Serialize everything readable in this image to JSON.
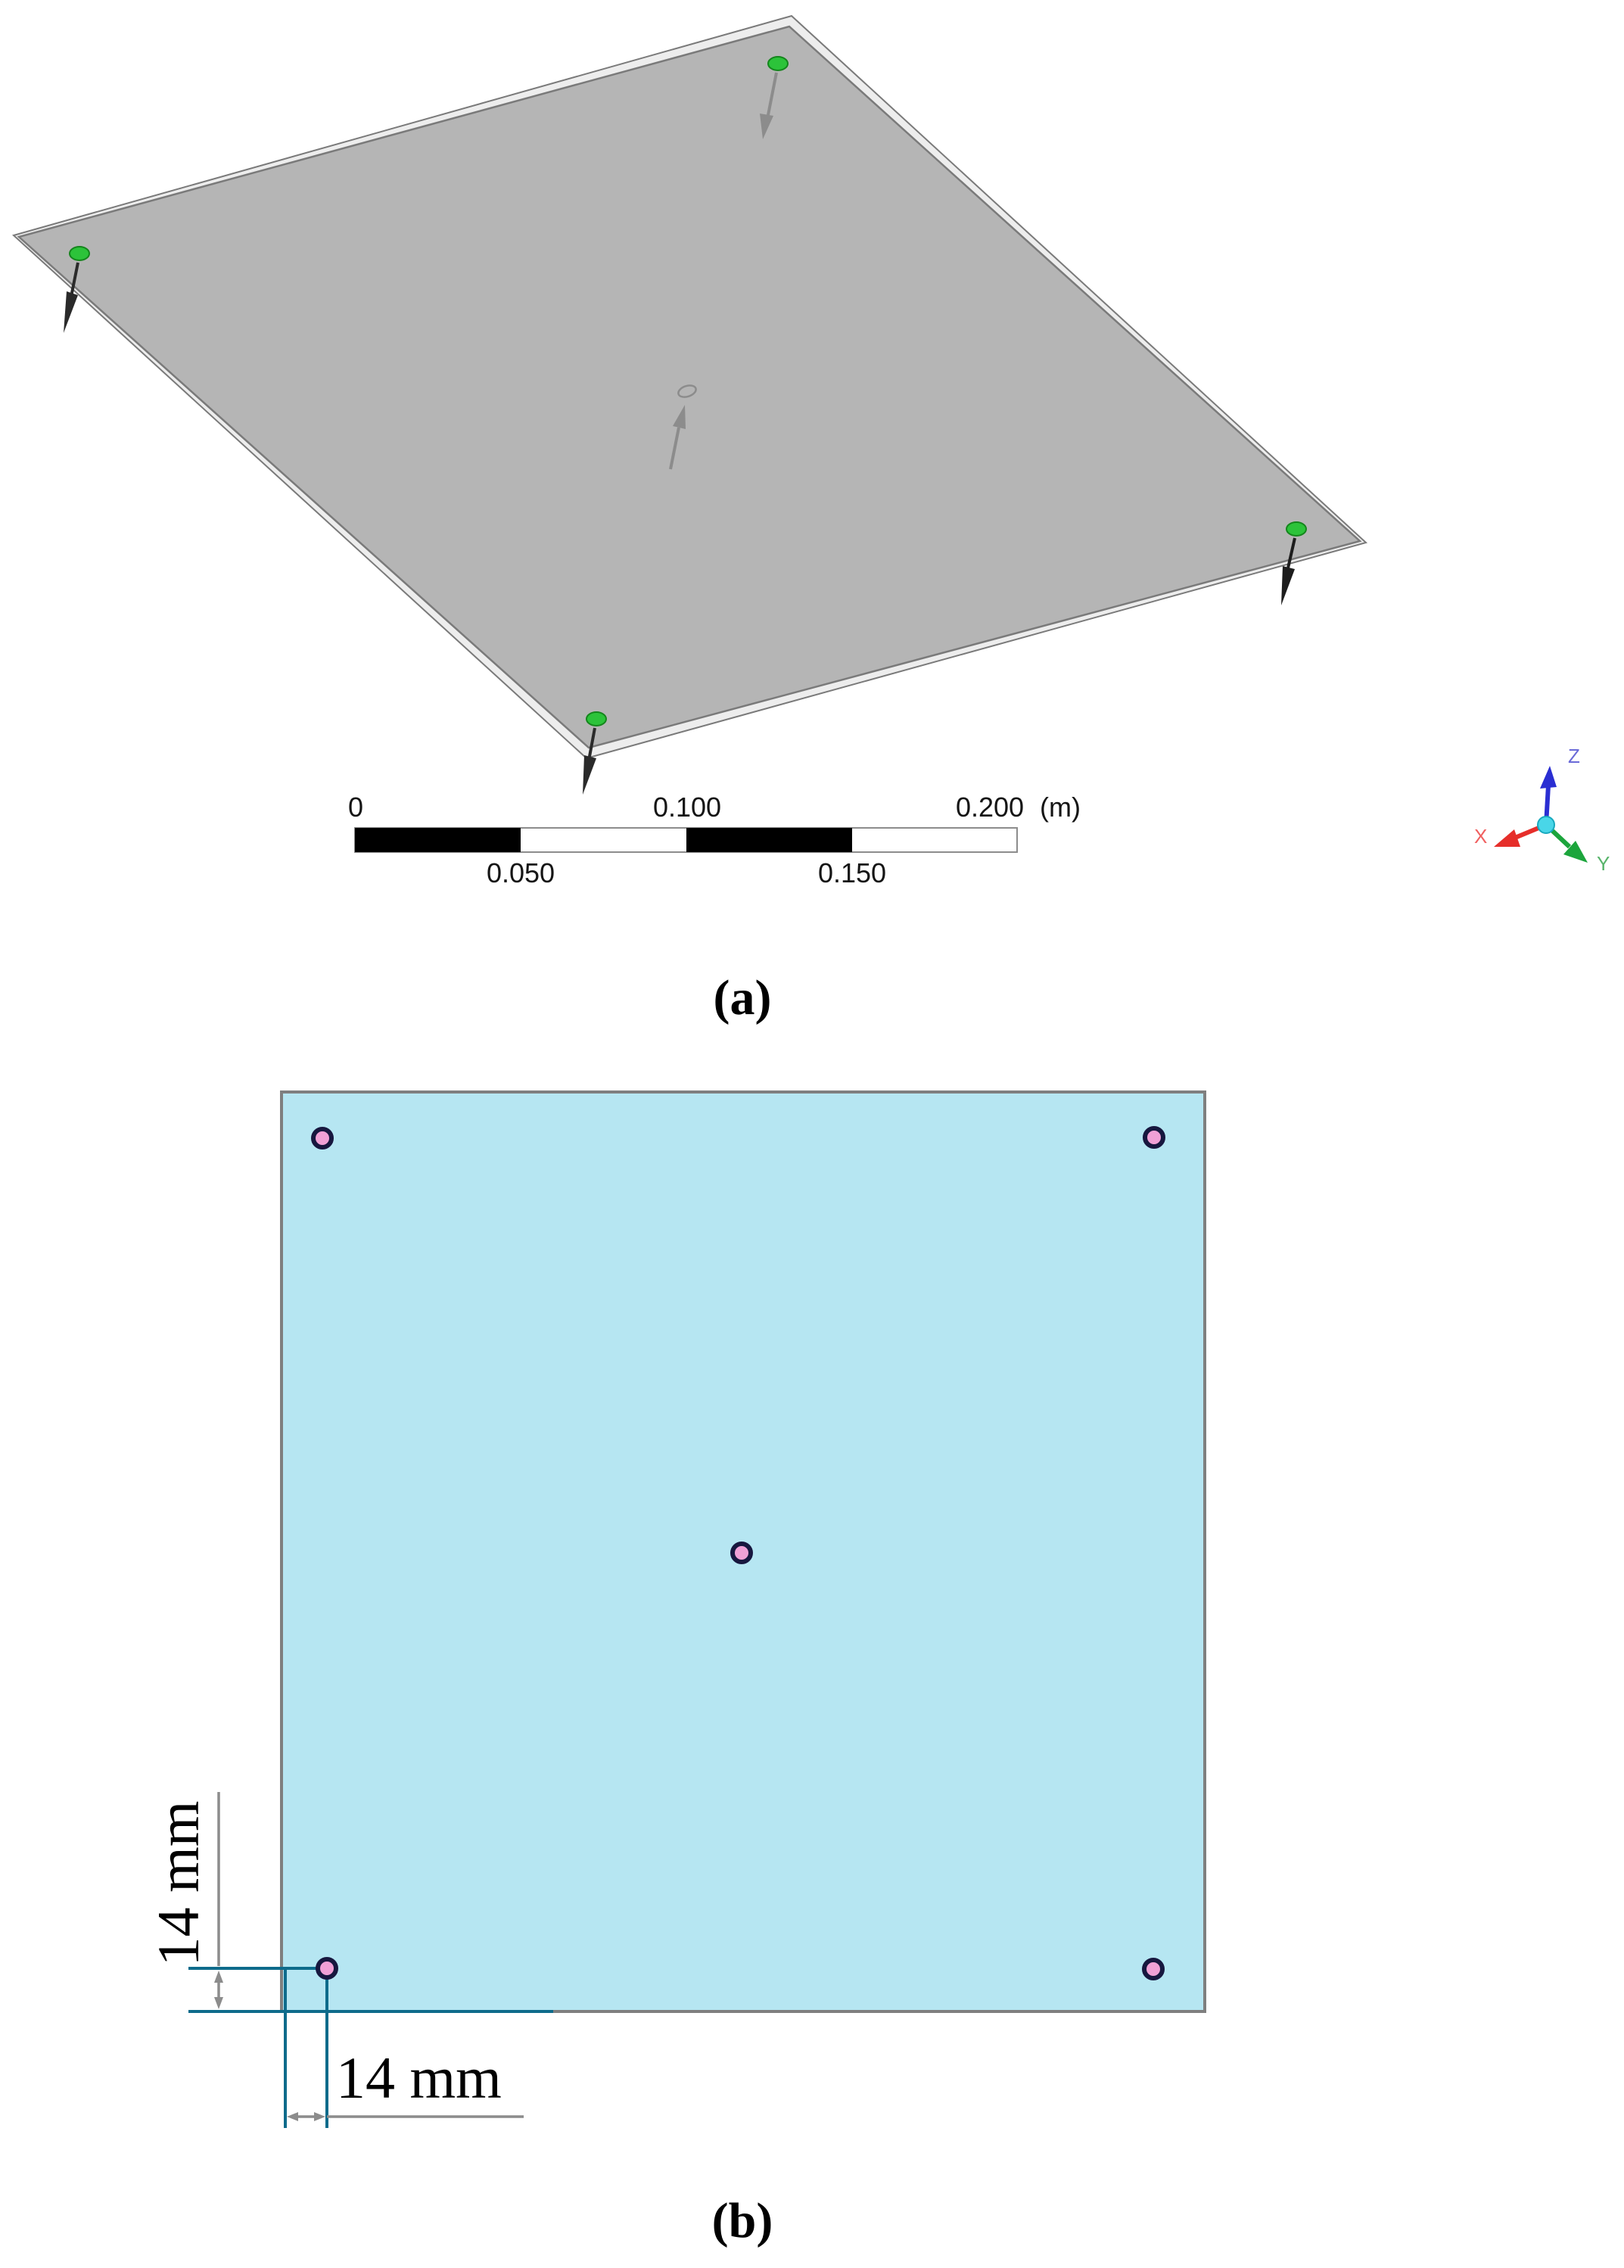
{
  "figure_a": {
    "label": "(a)",
    "scale_bar": {
      "tick_0": "0",
      "tick_050": "0.050",
      "tick_100": "0.100",
      "tick_150": "0.150",
      "tick_200": "0.200",
      "unit": "(m)"
    },
    "triad": {
      "x_label": "X",
      "y_label": "Y",
      "z_label": "Z"
    },
    "colors": {
      "plate_fill": "#b5b5b5",
      "plate_rim": "#ededed",
      "plate_edge": "#7a7a7a",
      "corner_point": "#2cc33a",
      "corner_point_edge": "#14861c",
      "arrow_gray": "#8c8c8c",
      "arrow_dark": "#2a2a2a",
      "triad_x": "#e62e2a",
      "triad_y": "#1ca53c",
      "triad_z": "#2a2ed2",
      "triad_x_label": "#f06060",
      "triad_y_label": "#57b46a",
      "triad_z_label": "#6a6ad8",
      "origin_ball": "#49d6e8"
    }
  },
  "figure_b": {
    "label": "(b)",
    "dim_left": "14 mm",
    "dim_bottom": "14 mm",
    "colors": {
      "plate_fill": "#b6e6f2",
      "plate_border": "#7f7f7f",
      "hole_fill": "#f0a0d6",
      "hole_stroke": "#17173f",
      "dim_line": "#0e6b8b",
      "dim_aux": "#8c8c8c"
    }
  }
}
